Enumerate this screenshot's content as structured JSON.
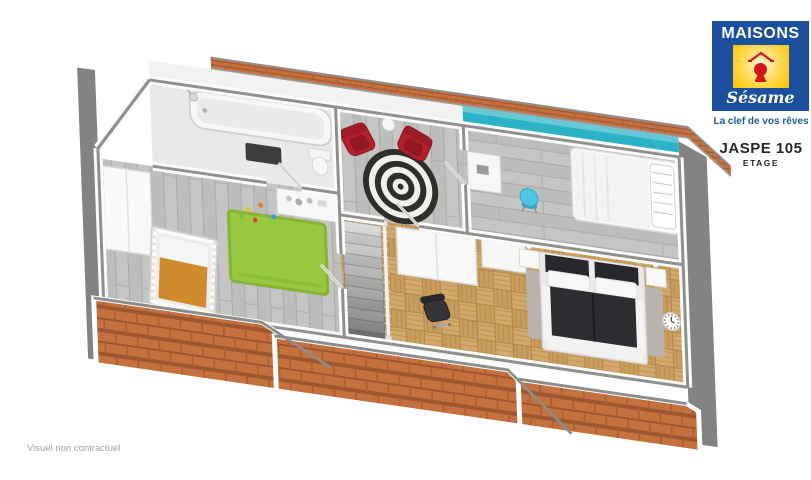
{
  "header": {
    "logo_line1": "MAISONS",
    "logo_line2": "Sésame",
    "tagline": "La clef de vos rêves",
    "plan_name": "JASPE 105",
    "floor_label": "ETAGE"
  },
  "footer": {
    "disclaimer": "Visuel non contractuel"
  },
  "colors": {
    "logo_blue": "#1c509f",
    "logo_yellow": "#ffd200",
    "logo_red": "#d8131c",
    "roof_tile": "#c4713d",
    "rim_gray": "#838381",
    "teal_wall": "#2cb2c5",
    "rug_green": "#97c83d",
    "accent_red": "#b2212b",
    "accent_turquoise": "#4cc7e2",
    "bed_dark": "#2e2e32",
    "floor_gray": "#bdbdbb",
    "parquet_wood": "#d1a96d",
    "wall_top_gray": "#8f8f8d"
  }
}
